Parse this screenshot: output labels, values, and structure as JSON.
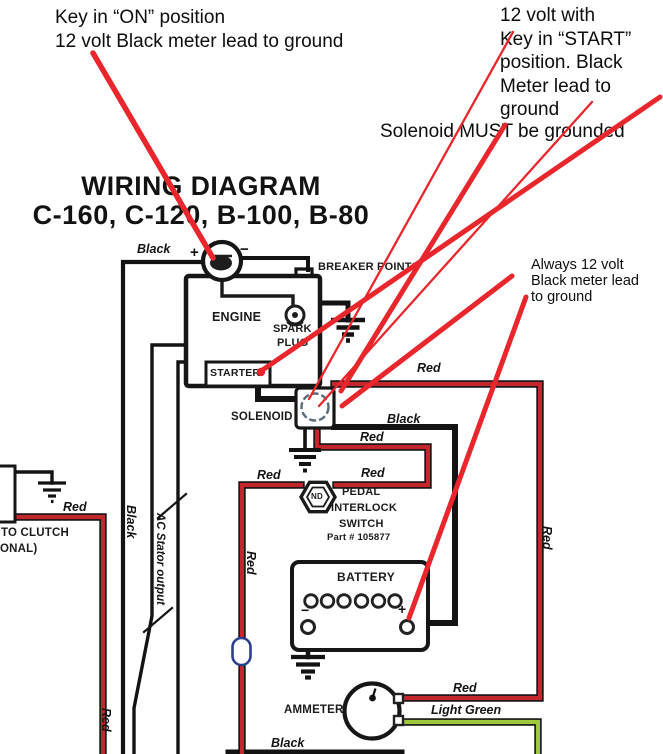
{
  "annotations": {
    "key_on": {
      "line1": "Key in “ON” position",
      "line2": "12 volt Black meter lead to ground"
    },
    "start": {
      "line1": "12 volt with",
      "line2": "Key in “START”",
      "line3": "position. Black",
      "line4": "Meter lead to",
      "line5": "ground"
    },
    "solenoid_grounded": "Solenoid MUST be grounded",
    "always": {
      "line1": "Always 12 volt",
      "line2": "Black meter lead",
      "line3": "to ground"
    }
  },
  "title": {
    "line1": "WIRING DIAGRAM",
    "line2": "C-160, C-120, B-100, B-80"
  },
  "components": {
    "breaker_points": "BREAKER POINTS",
    "engine": "ENGINE",
    "spark": "SPARK",
    "plug": "PLUG",
    "starter": "STARTER",
    "solenoid": "SOLENOID",
    "pedal": "PEDAL",
    "interlock": "INTERLOCK",
    "switch": "SWITCH",
    "part_number": "Part # 105877",
    "battery": "BATTERY",
    "ammeter": "AMMETER",
    "to_clutch": "TO CLUTCH",
    "optional_partial": "ONAL)",
    "interlock_symbol": "ND"
  },
  "wire_labels": {
    "black": "Black",
    "red": "Red",
    "light_green": "Light Green",
    "ac_stator": "AC Stator output"
  },
  "symbols": {
    "plus": "+",
    "minus": "−"
  },
  "colors": {
    "wire_red": "#c1272d",
    "annotation_red": "#e8262b",
    "wire_light_green": "#9fc93c",
    "wire_black": "#131313"
  }
}
